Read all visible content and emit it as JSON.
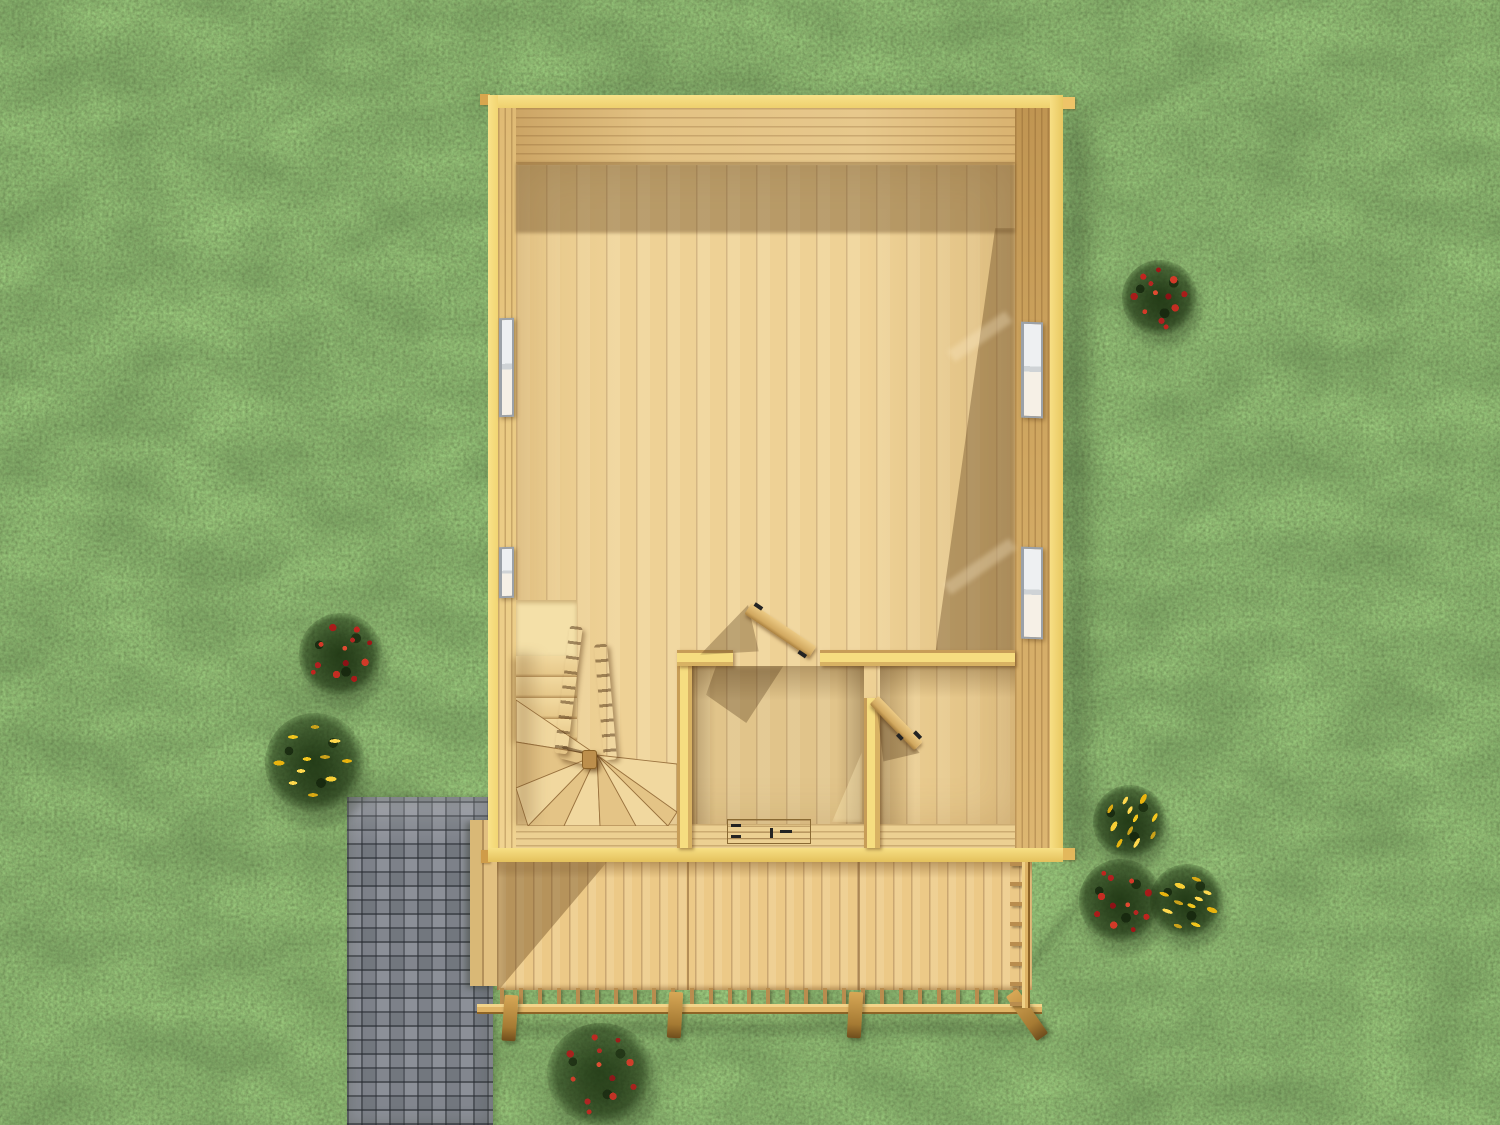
{
  "scene": {
    "type": "3d-architecture-render",
    "view": "top-down",
    "subject": "Wooden cabin ground-floor cutaway seen from above, with open-plan main room, winder staircase, two small rooms, front deck with railing, paved walkway and flower bushes on a lawn",
    "environment": "grass lawn"
  },
  "palette": {
    "grass_base": "#5d8038",
    "grass_dark": "#3a5423",
    "grass_light": "#8aab54",
    "path_paver": "#7d828a",
    "path_joint": "#595e65",
    "wall_cap": "#f5db7c",
    "wall_face_lit": "#e6c47e",
    "wall_face_shaded": "#cfa660",
    "floor_lit": "#eed195",
    "floor_shadow": "#b9955e",
    "deck_wood": "#ecc987",
    "rail_wood": "#e0b465",
    "post_wood": "#a57a33",
    "window_frame": "#9ba1a8",
    "window_pane": "#eef0f2",
    "door_wood": "#d2a960",
    "hardware_black": "#232323",
    "flower_red": "#c1251f",
    "flower_yellow": "#f2c61d",
    "foliage_dark": "#2c481e"
  },
  "house": {
    "walls": {
      "material": "timber logs",
      "corner_tabs": 4
    },
    "rooms": [
      {
        "id": "main-room",
        "label": "main open room"
      },
      {
        "id": "stair-corner",
        "label": "staircase corner"
      },
      {
        "id": "middle-room",
        "label": "small middle room"
      },
      {
        "id": "side-room",
        "label": "right side room"
      }
    ],
    "windows": [
      {
        "id": "window-left-upper",
        "wall": "left",
        "panes": 2
      },
      {
        "id": "window-left-lower",
        "wall": "left",
        "panes": 2
      },
      {
        "id": "window-right-upper",
        "wall": "right",
        "panes": 2
      },
      {
        "id": "window-right-lower",
        "wall": "right",
        "panes": 2
      }
    ],
    "doors": [
      {
        "id": "door-middle-room",
        "state": "open",
        "swing": "into main room"
      },
      {
        "id": "door-side-room",
        "state": "open",
        "swing": "into side room"
      }
    ],
    "floor_hatch": {
      "room": "middle-room",
      "hinges": 2
    },
    "stairs": {
      "type": "winder",
      "straight_treads": 4,
      "winder_treads": 9,
      "railing_beams": 2,
      "newel_posts": 1
    }
  },
  "deck": {
    "planks_direction": "vertical",
    "side_step_boards": 2,
    "railing": {
      "bottom_balusters": 28,
      "right_balusters": 8,
      "support_posts": 4
    }
  },
  "landscape": {
    "path": {
      "material": "concrete pavers",
      "pattern": "basketweave",
      "color": "#7d828a"
    },
    "bushes": [
      {
        "id": "bush-red-top-right",
        "flower": "red"
      },
      {
        "id": "bush-red-left",
        "flower": "red"
      },
      {
        "id": "bush-yellow-left",
        "flower": "yellow"
      },
      {
        "id": "bush-yellow-right-upper",
        "flower": "yellow"
      },
      {
        "id": "bush-red-right",
        "flower": "red"
      },
      {
        "id": "bush-yellow-right-lower",
        "flower": "yellow"
      },
      {
        "id": "bush-red-bottom",
        "flower": "red"
      }
    ]
  }
}
